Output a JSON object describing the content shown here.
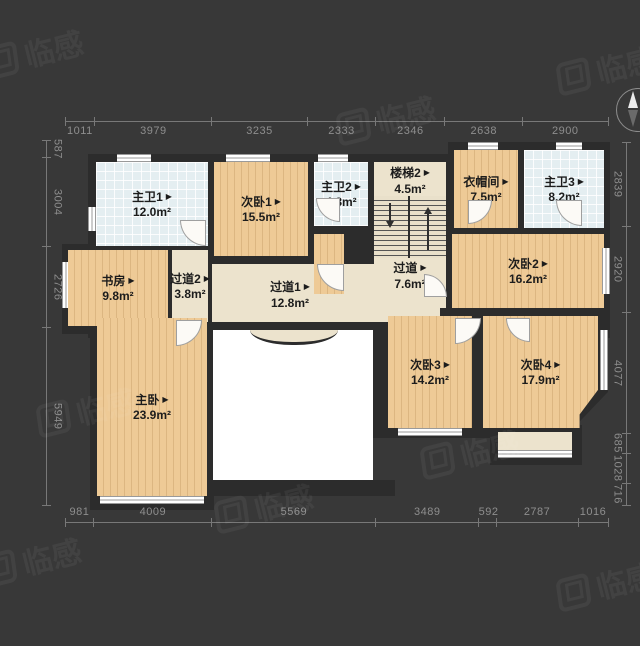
{
  "watermark": {
    "text": "临感"
  },
  "marker": "▶",
  "rooms": {
    "zhuwei1": {
      "name": "主卫1",
      "area": "12.0m²"
    },
    "ciwo1": {
      "name": "次卧1",
      "area": "15.5m²"
    },
    "zhuwei2": {
      "name": "主卫2",
      "area": "4.8m²"
    },
    "louti2": {
      "name": "楼梯2",
      "area": "4.5m²"
    },
    "yimaojian": {
      "name": "衣帽间",
      "area": "7.5m²"
    },
    "zhuwei3": {
      "name": "主卫3",
      "area": "8.2m²"
    },
    "shufang": {
      "name": "书房",
      "area": "9.8m²"
    },
    "guodao2": {
      "name": "过道2",
      "area": "3.8m²"
    },
    "guodao1": {
      "name": "过道1",
      "area": "12.8m²"
    },
    "guodao": {
      "name": "过道",
      "area": "7.6m²"
    },
    "ciwo2": {
      "name": "次卧2",
      "area": "16.2m²"
    },
    "zhuwo": {
      "name": "主卧",
      "area": "23.9m²"
    },
    "ciwo3": {
      "name": "次卧3",
      "area": "14.2m²"
    },
    "ciwo4": {
      "name": "次卧4",
      "area": "17.9m²"
    }
  },
  "dimensions": {
    "top": [
      1011,
      3979,
      3235,
      2333,
      2346,
      2638,
      2900
    ],
    "bottom": [
      981,
      4009,
      5569,
      3489,
      592,
      2787,
      1016
    ],
    "left": [
      587,
      3004,
      2726,
      5949
    ],
    "right": [
      2839,
      2920,
      4077,
      685,
      1028,
      716
    ]
  },
  "colors": {
    "background": "#383838",
    "wall": "#2c2c2c",
    "wood_floor": "#eeca96",
    "corridor_floor": "#ece3cd",
    "bath_tile": "#e4eef1",
    "void": "#ffffff",
    "dimension_text": "#8e8e8e",
    "label_text": "#1c1c1c"
  }
}
